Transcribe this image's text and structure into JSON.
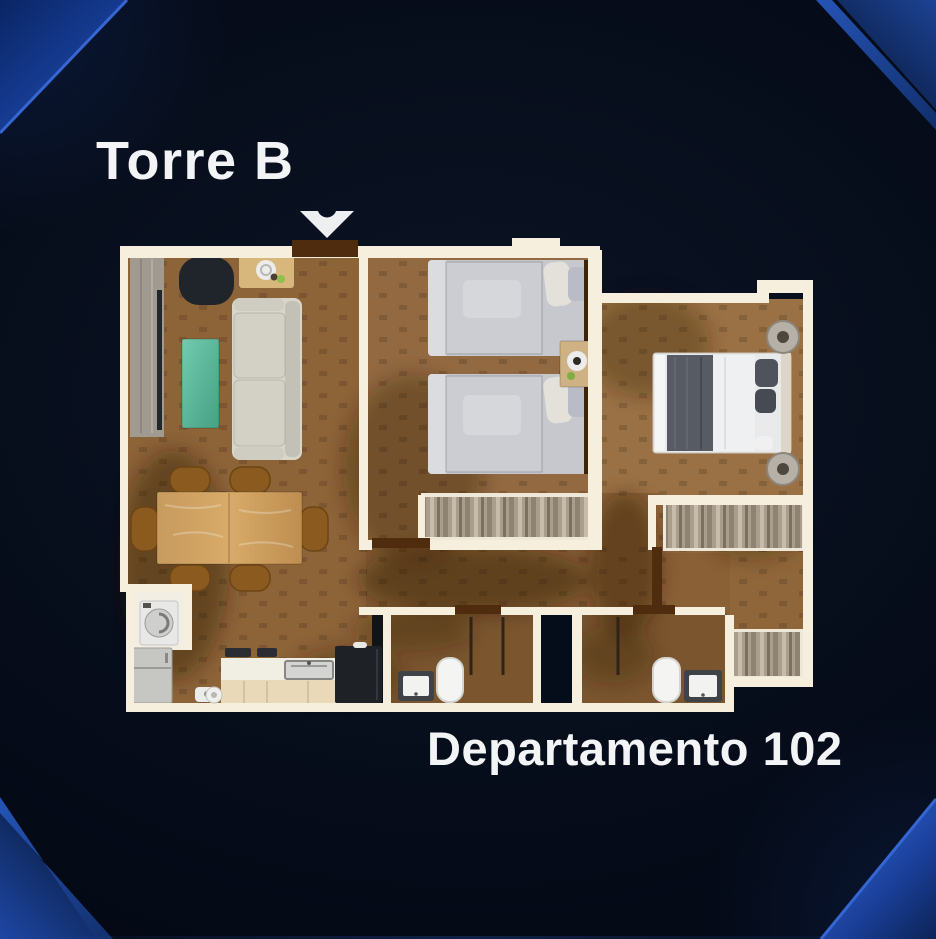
{
  "page": {
    "title": "Torre B",
    "subtitle": "Departamento 102"
  },
  "icons": {
    "entrance_arrow": "chevron-down-icon"
  },
  "palette": {
    "background": "#050b18",
    "text": "#f2f4f6",
    "accent_blue": "#1c4aa6",
    "accent_blue_bright": "#2e5ec6",
    "accent_blue_deep": "#081c45",
    "wall": "#f7efdd",
    "floor": "#8d6338",
    "floor_dark": "#7a552e",
    "door_wood": "#4f2c0d",
    "teal": "#5dbda0"
  },
  "floor_plan": {
    "unit_type": "2-bedroom apartment, top-down render",
    "rooms": [
      "living-dining-room",
      "kitchen",
      "laundry-closet",
      "secondary-bedroom",
      "master-bedroom",
      "walk-in-closet",
      "hallway",
      "bathroom",
      "en-suite-bathroom"
    ],
    "furniture": [
      "tv-console",
      "armchair",
      "side-table",
      "sofa",
      "coffee-table",
      "dining-table-6-chairs",
      "refrigerator",
      "washing-machine",
      "kitchen-counter-sink",
      "oven",
      "twin-bed",
      "twin-bed",
      "nightstand",
      "double-bed",
      "bedside-table",
      "bedside-table",
      "wardrobe",
      "wardrobe",
      "wardrobe",
      "toilet",
      "toilet",
      "sink",
      "sink"
    ]
  }
}
